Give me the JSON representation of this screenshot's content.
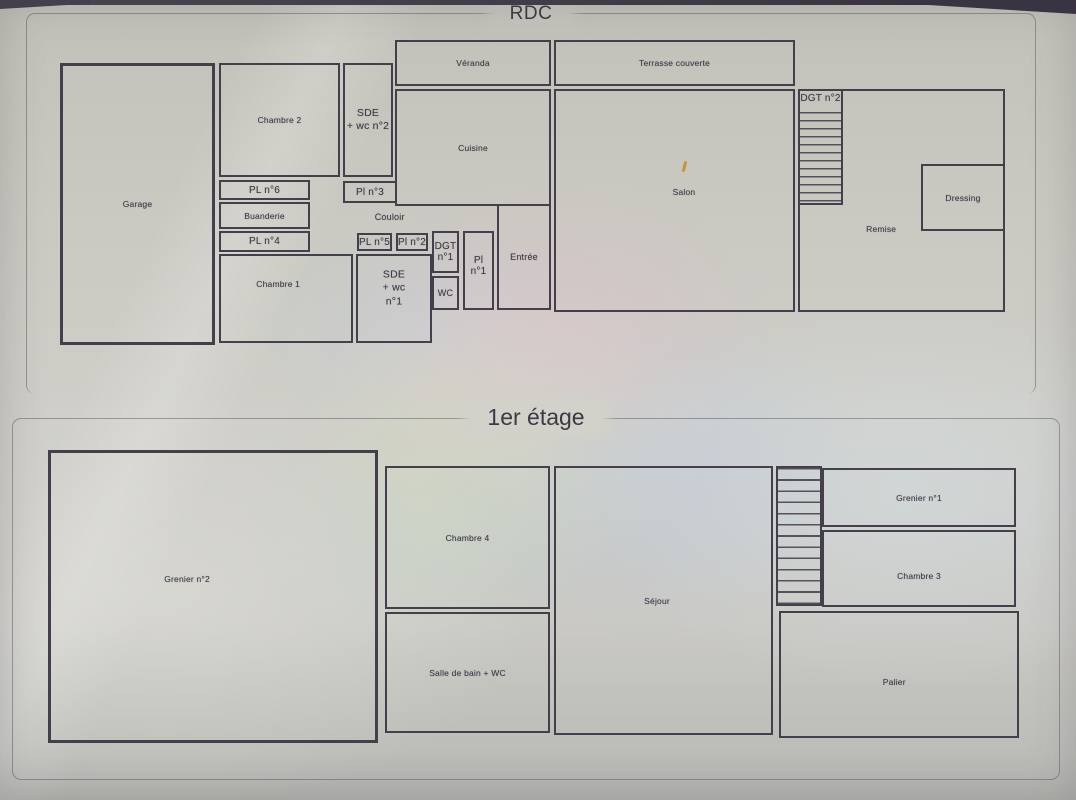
{
  "photo": {
    "description_titles_only": "",
    "colors": {
      "wall": "#453f4b",
      "paper": "#cac9c2",
      "ink": "#3b3744"
    }
  },
  "floors": [
    {
      "id": "rdc",
      "title": "RDC",
      "rooms": [
        {
          "id": "garage",
          "label": "Garage"
        },
        {
          "id": "chambre2",
          "label": "Chambre 2"
        },
        {
          "id": "sde2",
          "label": "SDE\n+ wc n°2"
        },
        {
          "id": "veranda",
          "label": "Véranda"
        },
        {
          "id": "terrasse",
          "label": "Terrasse couverte"
        },
        {
          "id": "cuisine",
          "label": "Cuisine"
        },
        {
          "id": "salon",
          "label": "Salon"
        },
        {
          "id": "remise",
          "label": "Remise"
        },
        {
          "id": "dgt2",
          "label": "DGT n°2"
        },
        {
          "id": "dressing",
          "label": "Dressing"
        },
        {
          "id": "pl6",
          "label": "PL n°6"
        },
        {
          "id": "pl3",
          "label": "Pl n°3"
        },
        {
          "id": "buanderie",
          "label": "Buanderie"
        },
        {
          "id": "couloir",
          "label": "Couloir"
        },
        {
          "id": "pl4",
          "label": "PL n°4"
        },
        {
          "id": "chambre1",
          "label": "Chambre 1"
        },
        {
          "id": "pl5",
          "label": "PL n°5"
        },
        {
          "id": "pl2",
          "label": "Pl n°2"
        },
        {
          "id": "dgt1",
          "label": "DGT\nn°1"
        },
        {
          "id": "wc",
          "label": "WC"
        },
        {
          "id": "sde1",
          "label": "SDE\n+ wc n°1"
        },
        {
          "id": "pl1",
          "label": "Pl\nn°1"
        },
        {
          "id": "entree",
          "label": "Entrée"
        }
      ]
    },
    {
      "id": "etage1",
      "title": "1er étage",
      "rooms": [
        {
          "id": "grenier2",
          "label": "Grenier n°2"
        },
        {
          "id": "chambre4",
          "label": "Chambre 4"
        },
        {
          "id": "sdb",
          "label": "Salle de bain + WC"
        },
        {
          "id": "sejour",
          "label": "Séjour"
        },
        {
          "id": "stairs1",
          "label": ""
        },
        {
          "id": "grenier1",
          "label": "Grenier n°1"
        },
        {
          "id": "chambre3",
          "label": "Chambre 3"
        },
        {
          "id": "palier",
          "label": "Palier"
        }
      ]
    }
  ]
}
